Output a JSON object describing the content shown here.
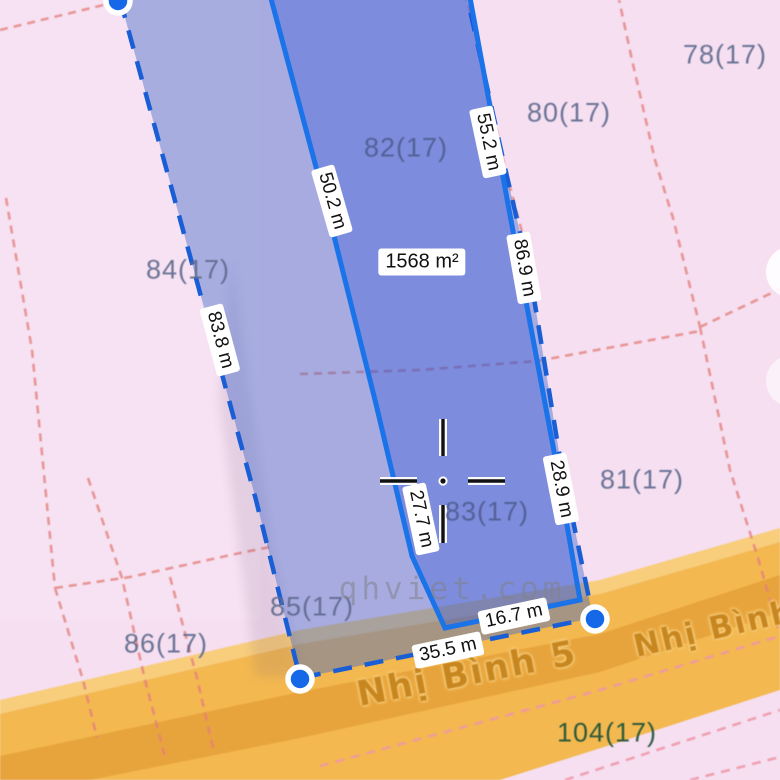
{
  "colors": {
    "background_pink": "#f5dff0",
    "road_orange": "#f3b850",
    "road_light_edge": "#f8cd7c",
    "road_label_band": "#e8a43c",
    "road_text": "#c8861f",
    "parcel_line_red": "#e5807d",
    "parcel_label": "#5f6a8e",
    "parcel_label_green": "#1d5237",
    "selection_blue": "#1a73e8",
    "selection_dash_blue": "#1a5ed6",
    "vertex_dot_blue": "#1569e8",
    "measure_text": "#111111",
    "measure_bg": "#ffffff",
    "watermark_gray": "#82828a"
  },
  "watermark": {
    "text": "qhviet.com",
    "x": 452,
    "y": 589,
    "angle": 0
  },
  "selection": {
    "area": {
      "text": "1568 m²",
      "x": 422,
      "y": 262,
      "angle": 0
    },
    "measurements": [
      {
        "text": "50.2 m",
        "x": 332,
        "y": 201,
        "angle": 74
      },
      {
        "text": "55.2 m",
        "x": 488,
        "y": 142,
        "angle": 78
      },
      {
        "text": "86.9 m",
        "x": 524,
        "y": 268,
        "angle": 80
      },
      {
        "text": "83.8 m",
        "x": 220,
        "y": 340,
        "angle": 75
      },
      {
        "text": "28.9 m",
        "x": 561,
        "y": 489,
        "angle": 79
      },
      {
        "text": "27.7 m",
        "x": 421,
        "y": 519,
        "angle": 78
      },
      {
        "text": "16.7 m",
        "x": 514,
        "y": 616,
        "angle": -12
      },
      {
        "text": "35.5 m",
        "x": 448,
        "y": 650,
        "angle": -12
      }
    ]
  },
  "parcels": [
    {
      "text": "78(17)",
      "x": 725,
      "y": 55,
      "color": "#5f6a8e"
    },
    {
      "text": "80(17)",
      "x": 569,
      "y": 113,
      "color": "#5f6a8e"
    },
    {
      "text": "82(17)",
      "x": 406,
      "y": 148,
      "color": "#505d92"
    },
    {
      "text": "84(17)",
      "x": 188,
      "y": 270,
      "color": "#5f6a8e"
    },
    {
      "text": "81(17)",
      "x": 642,
      "y": 480,
      "color": "#5f6a8e"
    },
    {
      "text": "83(17)",
      "x": 487,
      "y": 512,
      "color": "#505d92"
    },
    {
      "text": "85(17)",
      "x": 312,
      "y": 607,
      "color": "#5f6a8e"
    },
    {
      "text": "86(17)",
      "x": 166,
      "y": 644,
      "color": "#5f6a8e"
    },
    {
      "text": "104(17)",
      "x": 607,
      "y": 733,
      "color": "#1d5237"
    }
  ],
  "roads": [
    {
      "name": "Nhị Bình 5",
      "x": 467,
      "y": 674,
      "angle": -11
    },
    {
      "name": "Nhị Bình",
      "x": 714,
      "y": 629,
      "angle": -13
    }
  ]
}
